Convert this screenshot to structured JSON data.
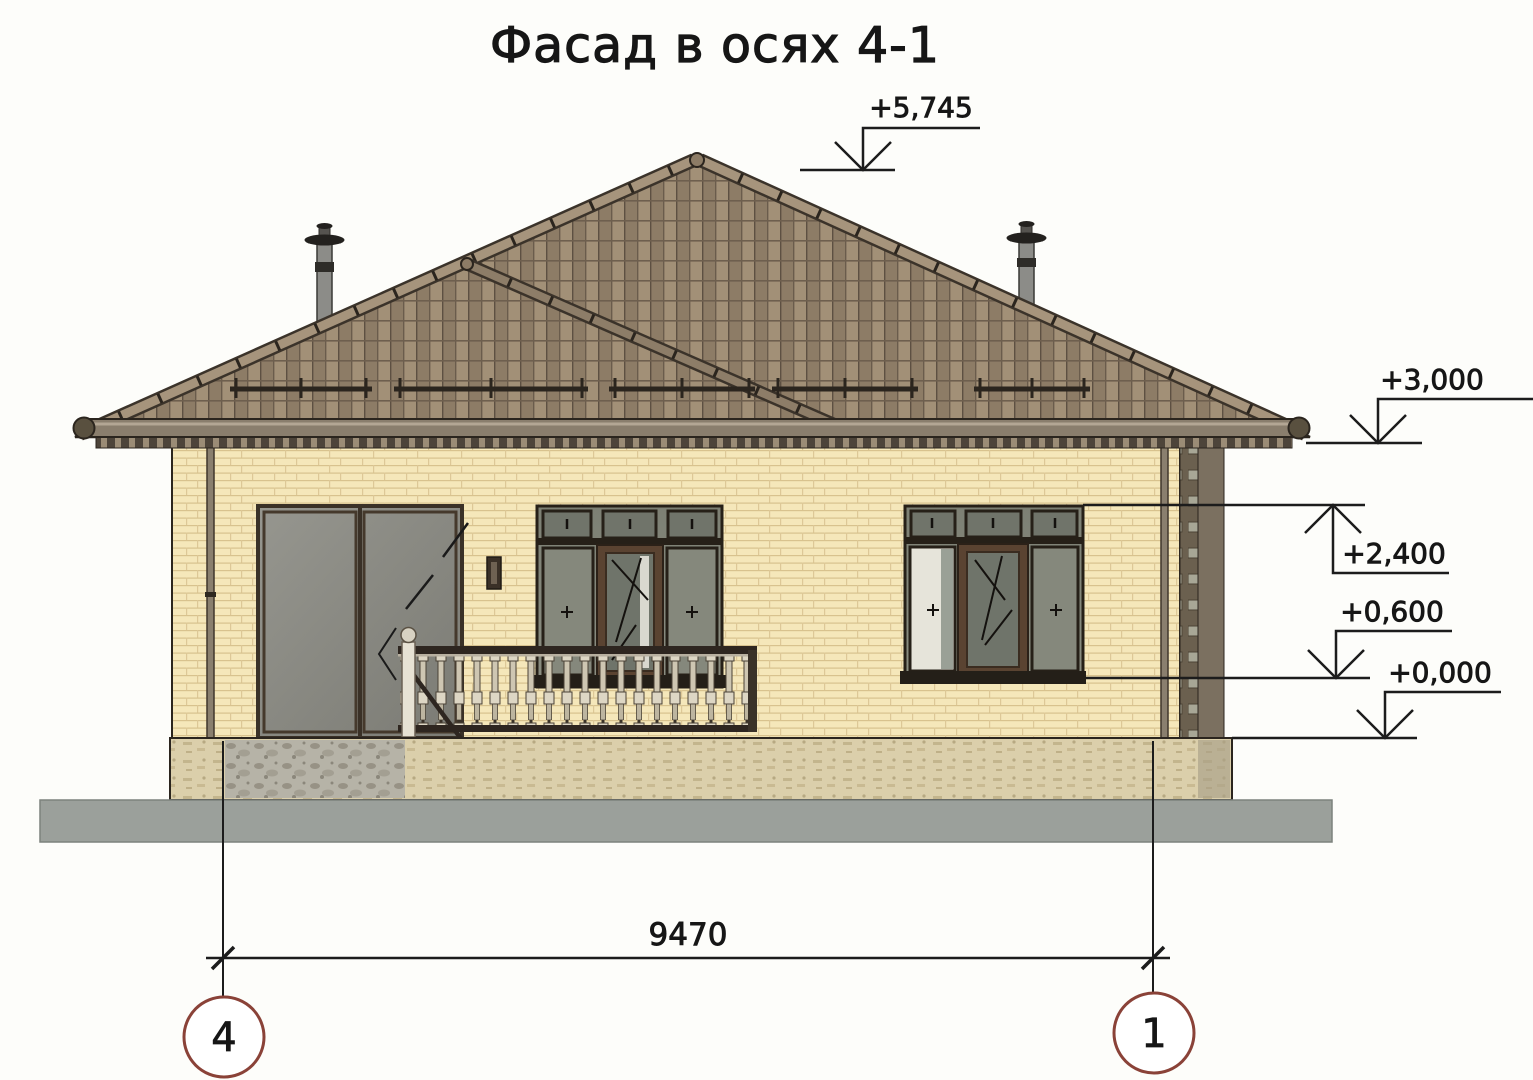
{
  "title": "Фасад в осях 4-1",
  "marks": {
    "ridge": "+5,745",
    "eave": "+3,000",
    "window_top": "+2,400",
    "window_sill": "+0,600",
    "zero": "+0,000"
  },
  "dimension": {
    "width": "9470"
  },
  "axes": {
    "left": "4",
    "right": "1"
  },
  "colors": {
    "ink": "#1c1c1c",
    "axis_bubble_border": "#8a4238",
    "brick_wall": "#f5e7ba",
    "brick_mortar": "#d8c28e",
    "roof_tile": "#a29077",
    "roof_tile_dark": "#8d7c66",
    "window_glass": "#85887c",
    "window_frame_brown": "#5a4331",
    "door_glass": "#8e8e86",
    "plinth": "#dbcfab",
    "ground": "#9ba09b"
  }
}
